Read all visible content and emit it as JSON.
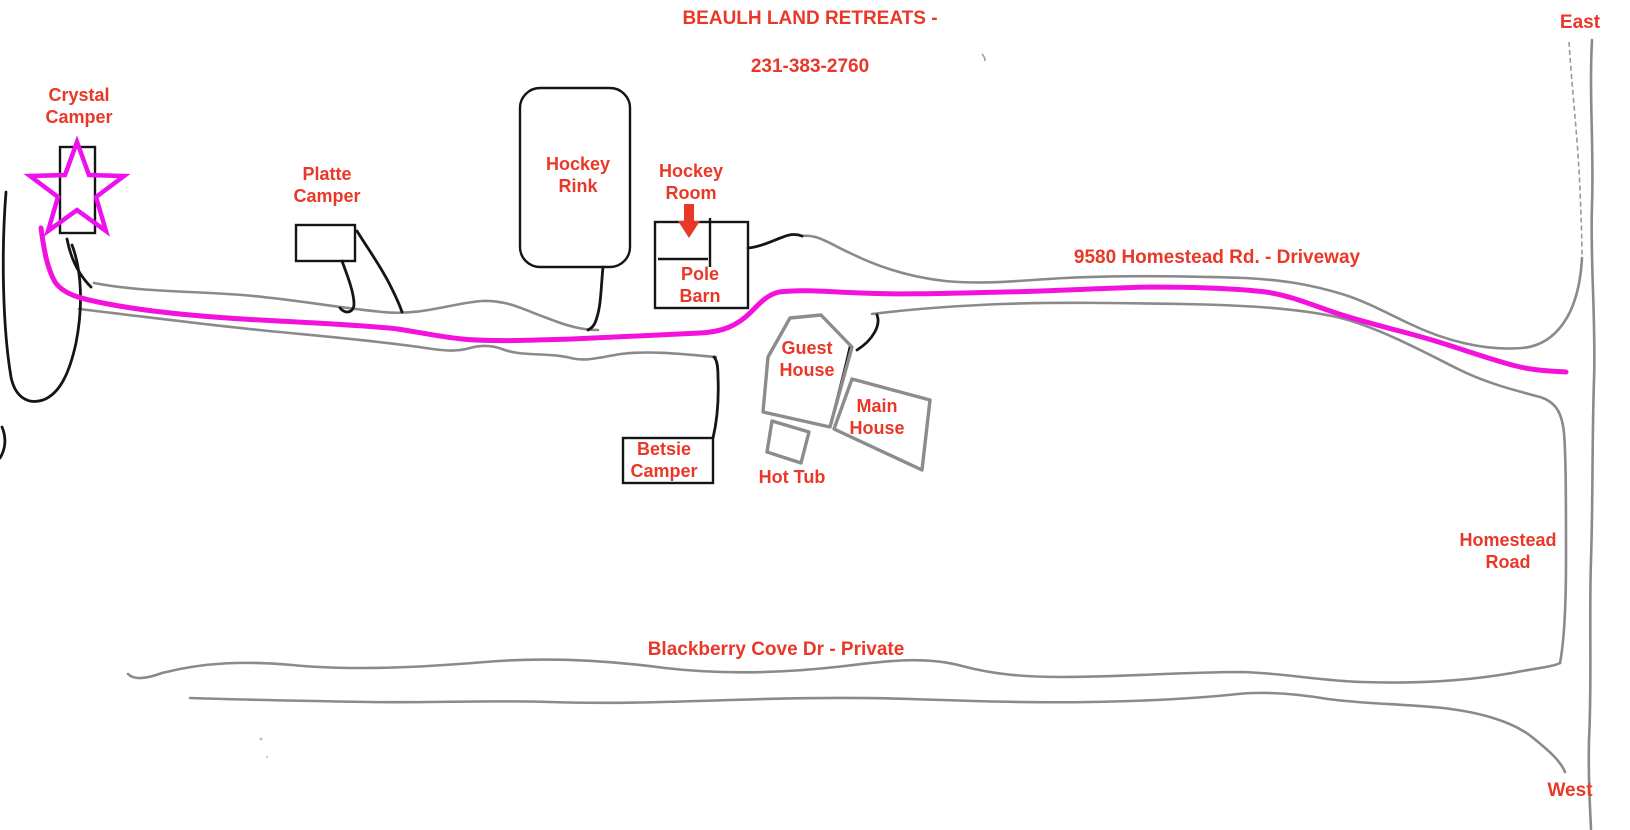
{
  "title": {
    "line1": "BEAULH LAND RETREATS -",
    "line2": "231-383-2760"
  },
  "labels": {
    "east": "East",
    "west": "West",
    "crystal_camper": "Crystal\nCamper",
    "platte_camper": "Platte\nCamper",
    "hockey_rink": "Hockey\nRink",
    "hockey_room": "Hockey\nRoom",
    "pole_barn": "Pole\nBarn",
    "driveway": "9580 Homestead Rd. - Driveway",
    "guest_house": "Guest\nHouse",
    "main_house": "Main\nHouse",
    "hot_tub": "Hot Tub",
    "betsie_camper": "Betsie\nCamper",
    "homestead_road": "Homestead\nRoad",
    "blackberry": "Blackberry Cove Dr - Private"
  },
  "colors": {
    "label_red": "#e93828",
    "route_magenta": "#f312dc",
    "star_magenta": "#ee10ee",
    "road_gray": "#8a8a8a",
    "faint_gray": "#9a9a9a",
    "ink_black": "#151515",
    "house_gray": "#8c8c8c"
  }
}
